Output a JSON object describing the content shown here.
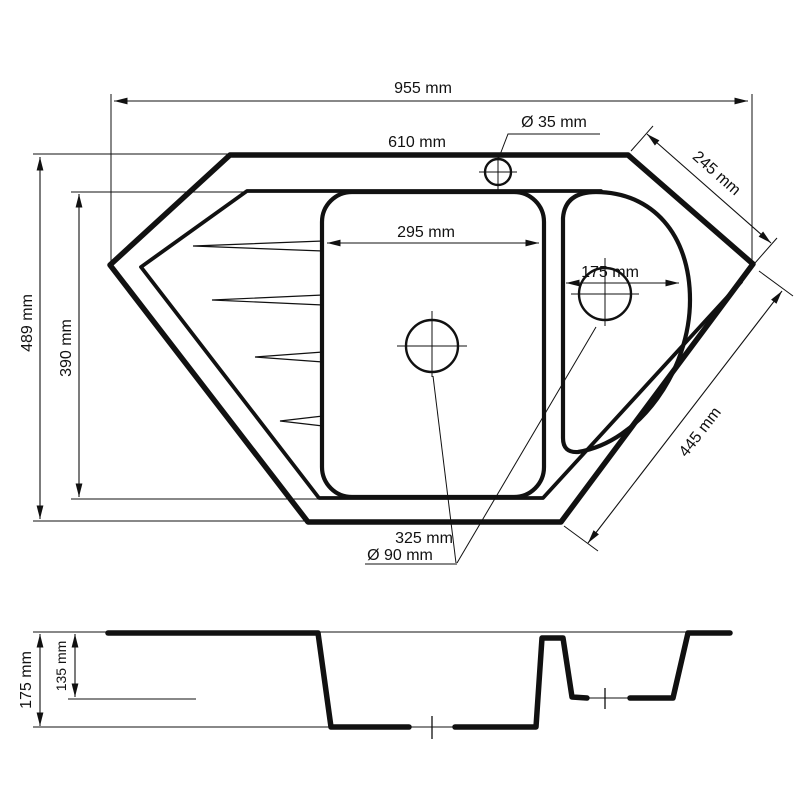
{
  "drawing": {
    "description": "Technical dimension drawing of a corner kitchen sink: top view with two bowls and drainer grooves, plus section profile view",
    "line_color": "#111111",
    "background_color": "#ffffff"
  },
  "top_view": {
    "overall_width": "955 mm",
    "top_edge_width": "610 mm",
    "faucet_hole_diameter": "Ø 35 mm",
    "right_upper_edge": "245 mm",
    "overall_height": "489 mm",
    "basin_height": "390 mm",
    "main_bowl_width": "295 mm",
    "small_bowl_width": "175 mm",
    "right_lower_edge": "445 mm",
    "bottom_edge_width": "325 mm",
    "drain_diameter": "Ø 90 mm"
  },
  "section_view": {
    "overall_depth": "175 mm",
    "small_bowl_depth": "135 mm"
  }
}
